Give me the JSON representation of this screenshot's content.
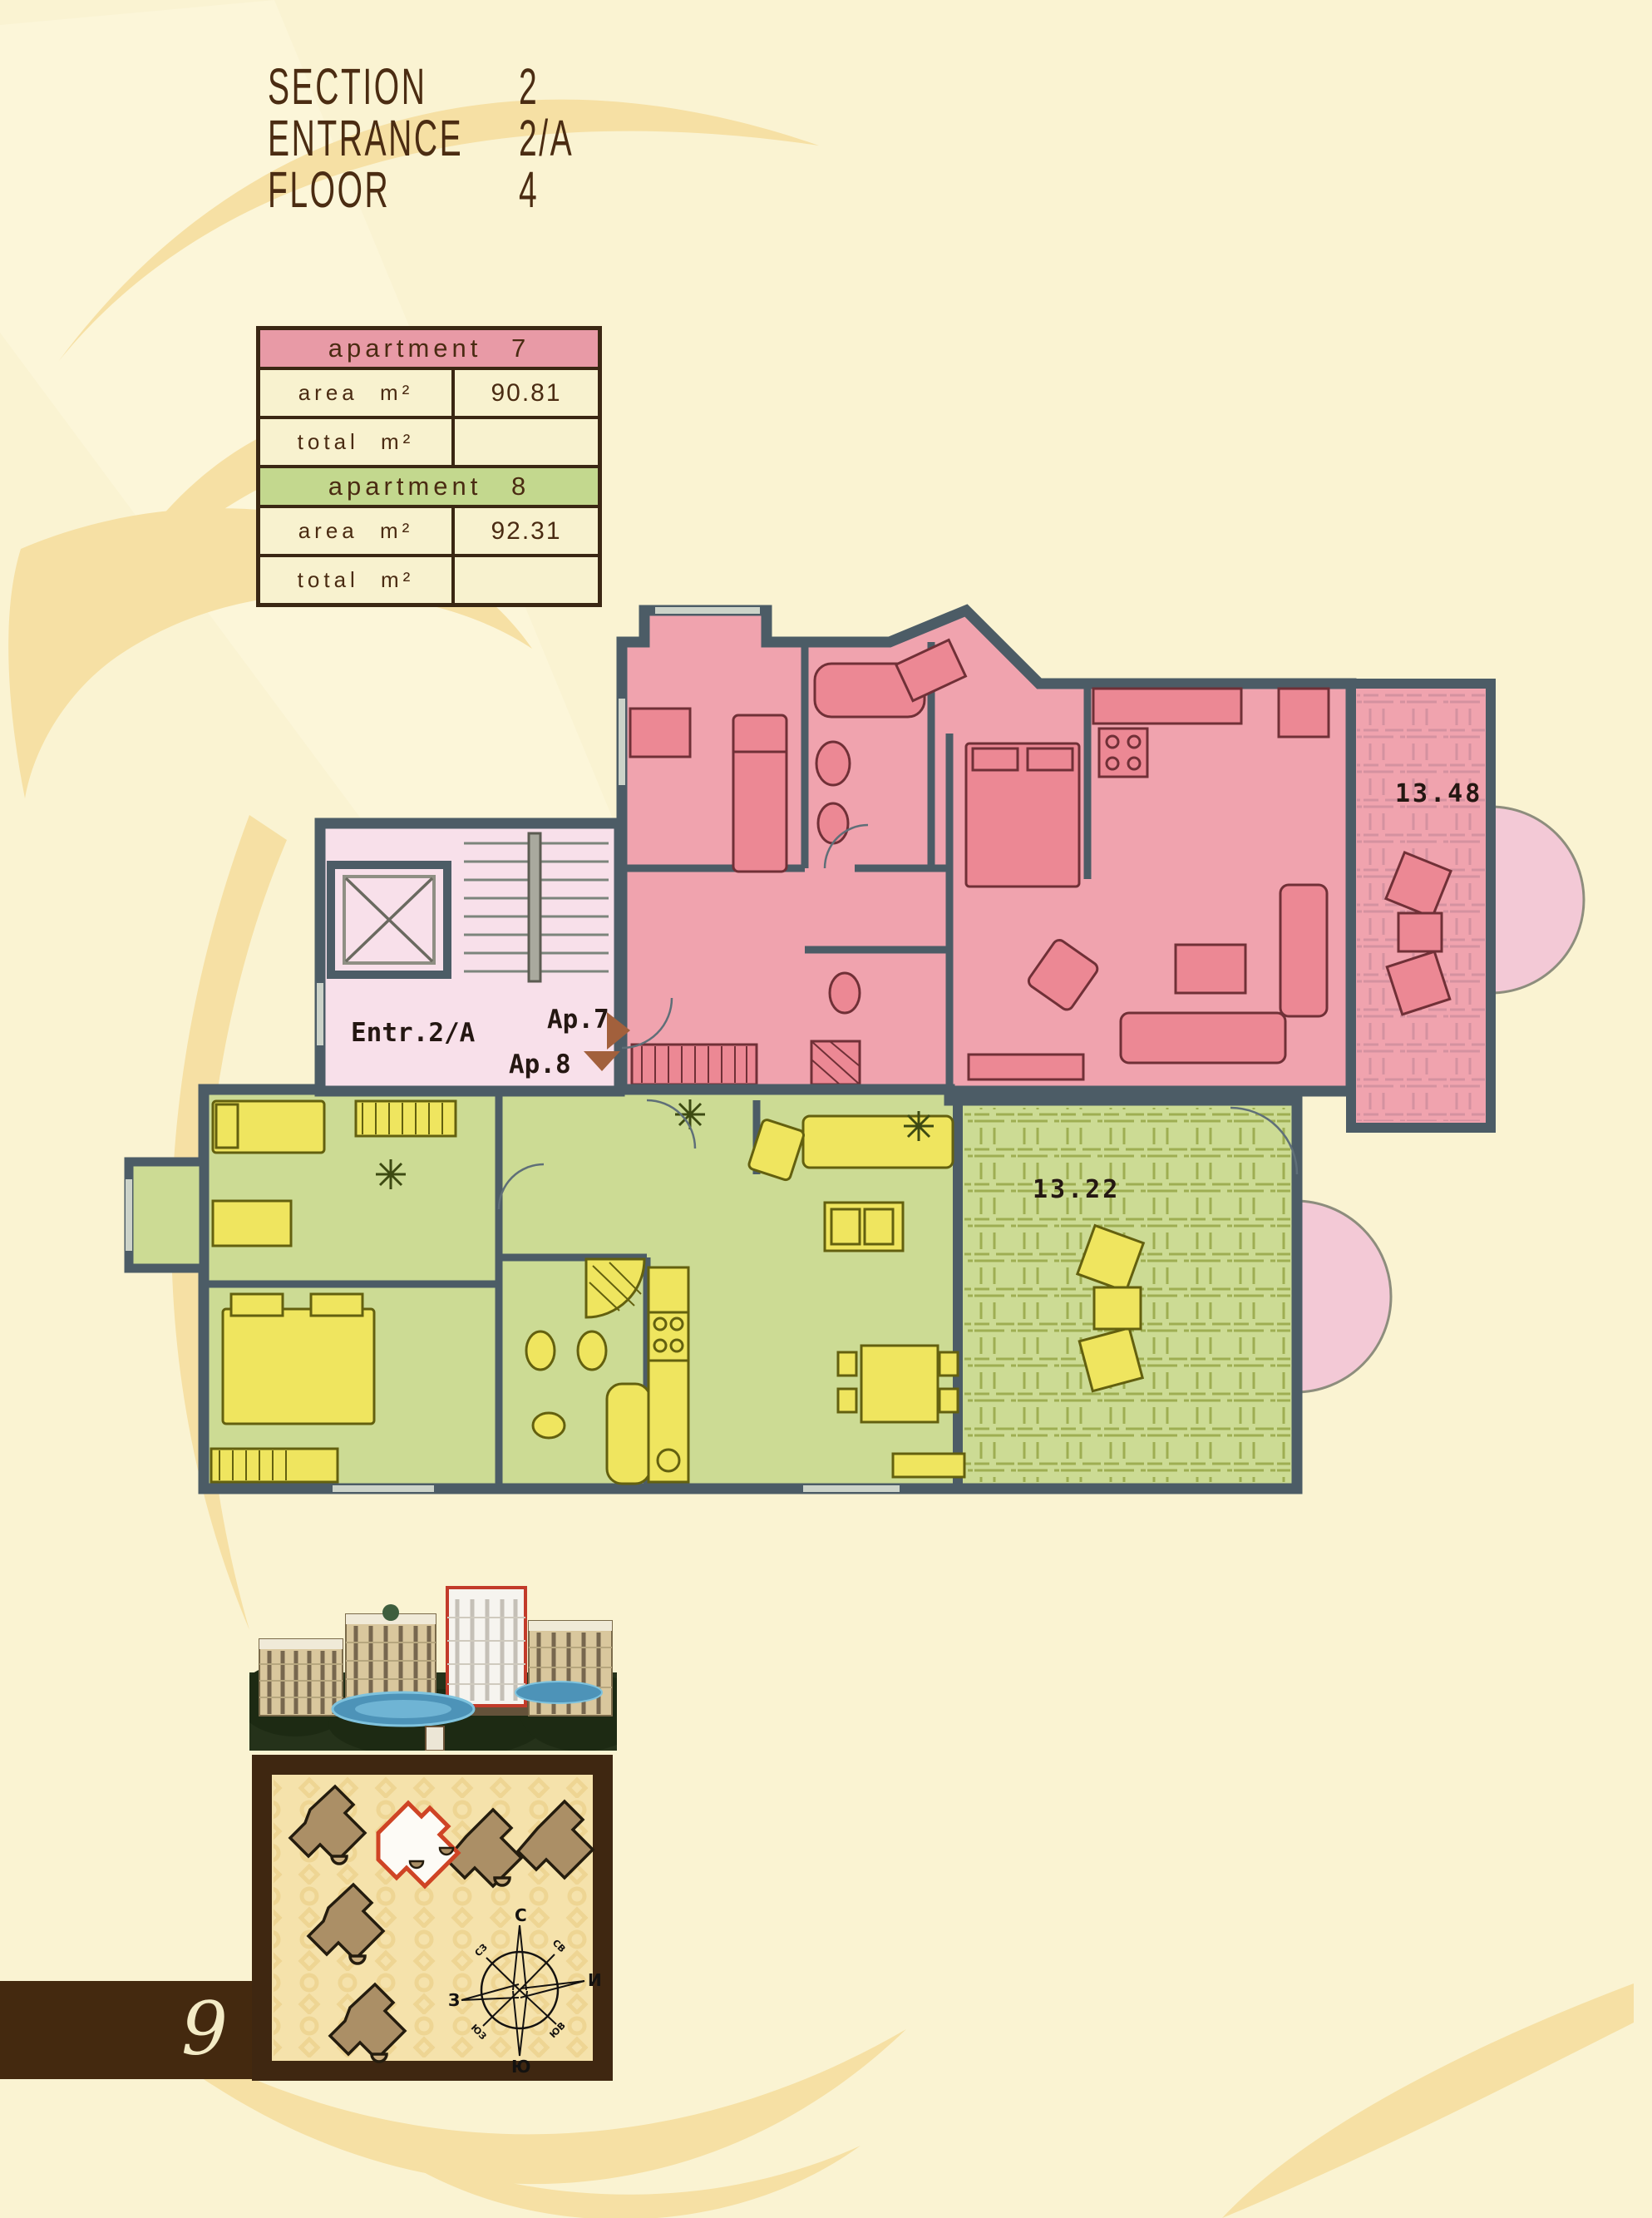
{
  "page": {
    "number": "9",
    "bg": "#faf3d2",
    "bar_color": "#44290f"
  },
  "header": {
    "rows": [
      {
        "label": "SECTION",
        "value": "2"
      },
      {
        "label": "ENTRANCE",
        "value": "2/A"
      },
      {
        "label": "FLOOR",
        "value": "4"
      }
    ]
  },
  "table": {
    "area_label": "area m²",
    "total_label": "total m²",
    "apartments": [
      {
        "name": "apartment 7",
        "color": "#e89aa6",
        "area": "90.81",
        "total": ""
      },
      {
        "name": "apartment 8",
        "color": "#c3d88e",
        "area": "92.31",
        "total": ""
      }
    ]
  },
  "plan": {
    "entrance_label": "Entr.2/A",
    "ap7_label": "Ap.7",
    "ap8_label": "Ap.8",
    "ap7_balcony_area": "13.48",
    "ap8_balcony_area": "13.22",
    "colors": {
      "wall": "#4c5c66",
      "ap7_fill": "#f0a3ae",
      "ap8_fill": "#ccdb94",
      "hall_fill": "#f8e0ea",
      "bay_fill": "#f3c9d6",
      "arrow": "#a2603c"
    }
  },
  "site_plan": {
    "highlight_color": "#cf4425",
    "building_color": "#ab8f66",
    "compass": {
      "n": "С",
      "ne": "СВ",
      "e": "И",
      "se": "ЮВ",
      "s": "Ю",
      "sw": "ЮЗ",
      "w": "З",
      "nw": "СЗ"
    }
  }
}
